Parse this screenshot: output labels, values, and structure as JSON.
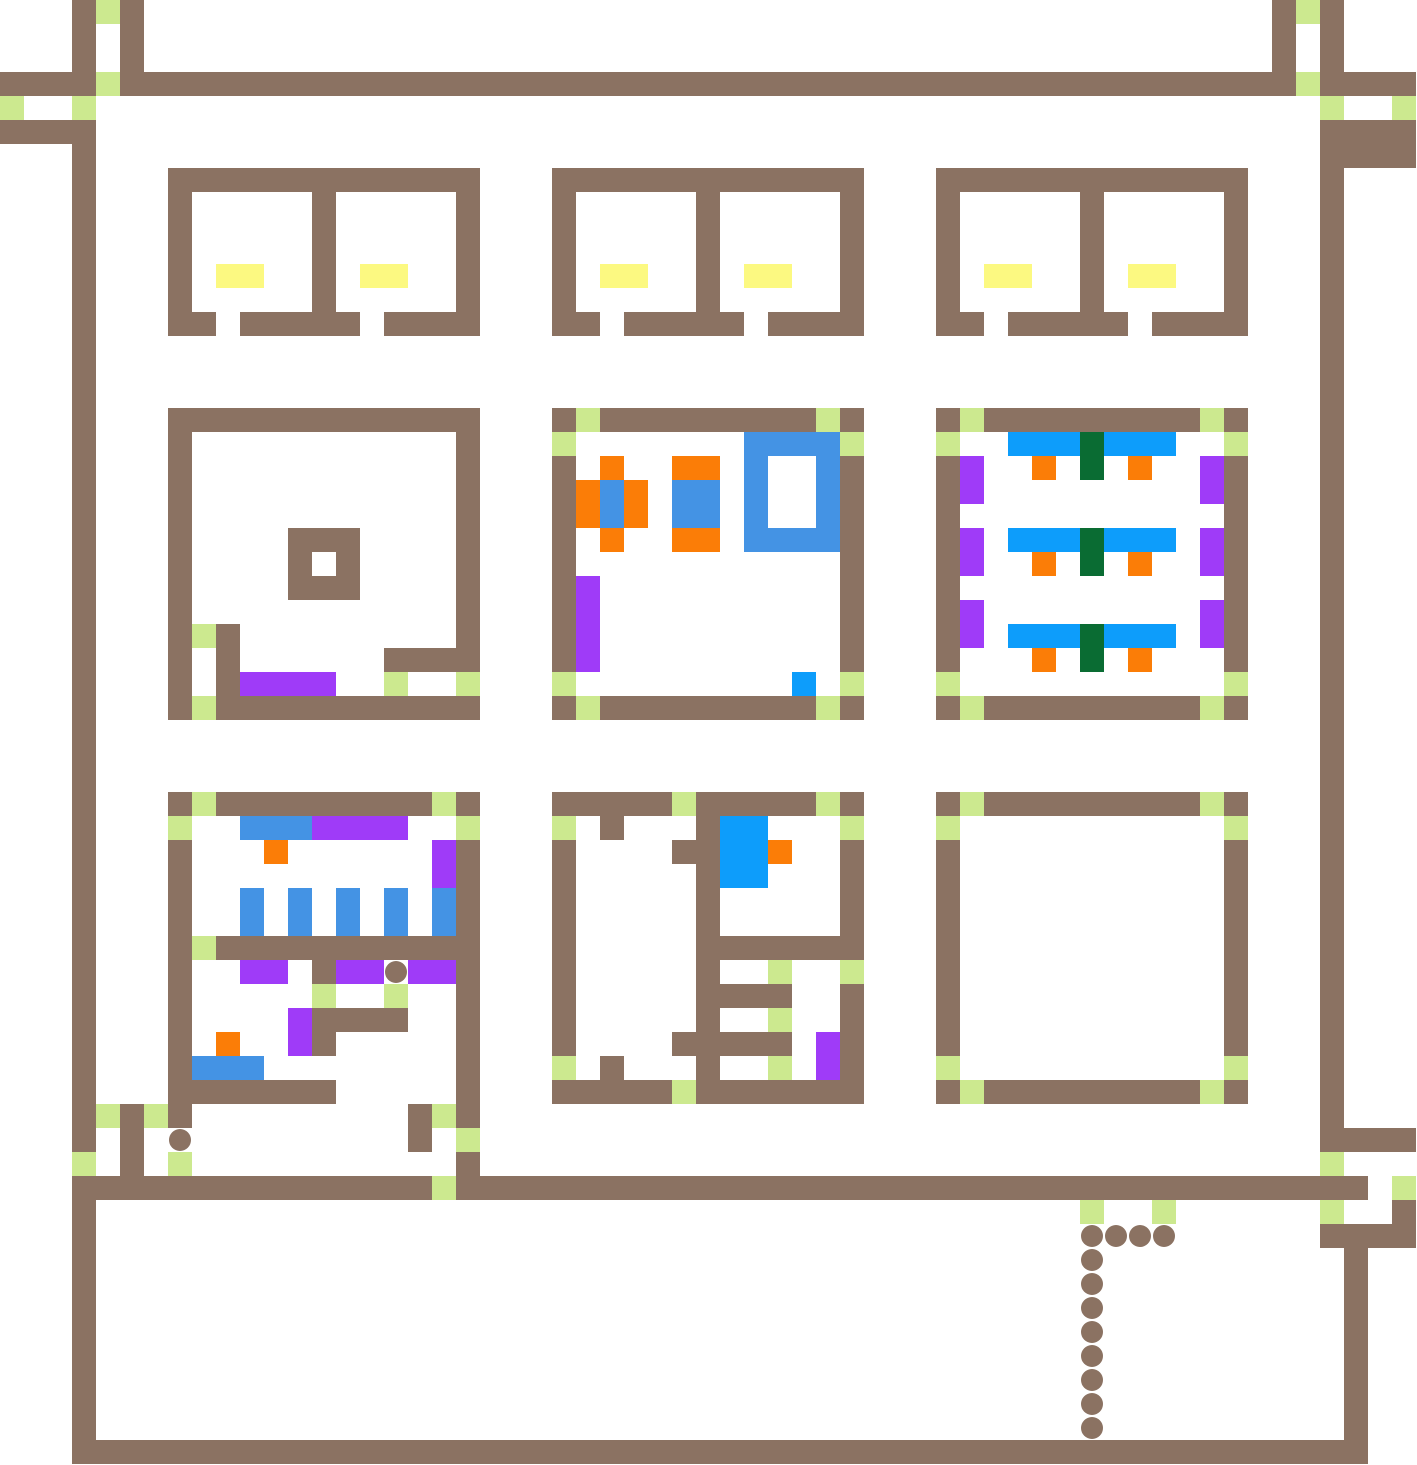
{
  "map": {
    "grid_cols": 59,
    "grid_rows": 61,
    "cell_size": 24,
    "background": "#ffffff",
    "palette": {
      ".": "#ffffff",
      "W": "#8b7262",
      "D": "#cce98f",
      "Y": "#fcf981",
      "B": "#4493e4",
      "C": "#0d9dfb",
      "O": "#fb7d07",
      "P": "#9f3bf8",
      "G": "#0a6c33",
      "o": "#8b7262"
    },
    "legend": {
      ".": "floor",
      "W": "wall-segment",
      "D": "door-tile",
      "Y": "bed-tile",
      "B": "blue-furniture",
      "C": "bright-blue-furniture",
      "O": "orange-chair",
      "P": "purple-bench",
      "G": "green-table",
      "o": "path-dot"
    },
    "rows": [
      "3. W D W 47. W D W 3.",
      "3. W . W 47. W . W 3.",
      "3. W . W 47. W . W 3.",
      "4W D 49W D 4W",
      "D 2. D 51. D 2. D",
      "4W 51. 4W",
      "3. W 51. 4W",
      "3. W 3. 13W 3. 13W 3. 13W 3. W 3.",
      "3. W 3. W 5. W 5. W 3. W 5. W 5. W 3. W 5. W 5. W 3. W 3.",
      "3. W 3. W 5. W 5. W 3. W 5. W 5. W 3. W 5. W 5. W 3. W 3.",
      "3. W 3. W 5. W 5. W 3. W 5. W 5. W 3. W 5. W 5. W 3. W 3.",
      "3. W 3. W . 2Y 2. W . 2Y 2. W 3. W . 2Y 2. W . 2Y 2. W 3. W . 2Y 2. W . 2Y 2. W 3. W 3.",
      "3. W 3. W 5. W 5. W 3. W 5. W 5. W 3. W 5. W 5. W 3. W 3.",
      "3. W 3. 2W . 5W . 4W 3. 2W . 5W . 4W 3. 2W . 5W . 4W 3. W 3.",
      "3. W 51. W 3.",
      "3. W 51. W 3.",
      "3. W 51. W 3.",
      "3. W 3. 13W 3. W D 9W D W 3. W D 9W D W 3. W 3.",
      "3. W 3. W 11. W 3. D 7. 4B D 3. D 2. 3C G 3C 2. D 3. W 3.",
      "3. W 3. W 11. W 3. W . O 2. 2O . B 2. B W 3. W P 2. O . G . O 2. P W 3. W 3.",
      "3. W 3. W 11. W 3. W O B O . 2B . B 2. B W 3. W P 9. P W 3. W 3.",
      "3. W 3. W 11. W 3. W O B O . 2B . B 2. B W 3. W 11. W 3. W 3.",
      "3. W 3. W 4. 3W 4. W 3. W . O 2. 2O . 4B W 3. W P . 3C G 3C . P W 3. W 3.",
      "3. W 3. W 4. W . W 4. W 3. W 11. W 3. W P 2. O . G . O 2. P W 3. W 3.",
      "3. W 3. W 4. 3W 4. W 3. W P 10. W 3. W 11. W 3. W 3.",
      "3. W 3. W 11. W 3. W P 10. W 3. W P 9. P W 3. W 3.",
      "3. W 3. W D W 9. W 3. W P 10. W 3. W P . 3C G 3C . P W 3. W 3.",
      "3. W 3. W . W 6. 4W 3. W P 10. W 3. W 3. O . G . O 3. W 3. W 3.",
      "3. W 3. W . W 4P 2. D 2. D 3. D 9. C . D 3. D 11. D 3. W 3.",
      "3. W 3. W D 11W 3. W D 9W D W 3. W D 9W D W 3. W 3.",
      "3. W 51. W 3.",
      "3. W 51. W 3.",
      "3. W 51. W 3.",
      "3. W 3. W D 9W D W 3. 5W D 5W D W 3. W D 9W D W 3. W 3.",
      "3. W 3. D 2. 3B 4P 2. D 3. D . W 3. W 2C 3. D 3. D 11. D 3. W 3.",
      "3. W 3. W 3. O 6. P W 3. W 4. 2W 2C O 2. W 3. W 11. W 3. W 3.",
      "3. W 3. W 10. P W 3. W 5. W 2C 3. W 3. W 11. W 3. W 3.",
      "3. W 3. W 2. B . B . B . B . B W 3. W 5. W 5. W 3. W 11. W 3. W 3.",
      "3. W 3. W 2. B . B . B . B . B W 3. W 5. W 5. W 3. W 11. W 3. W 3.",
      "3. W 3. W D 11W 3. W 5. 7W 3. W 11. W 3. W 3.",
      "3. W 3. W 2. 2P . W 2P o 2P W 3. W 5. W 2. D 2. D 3. W 11. W 3. W 3.",
      "3. W 3. W 5. D 2. D 2. W 3. W 5. 4W 2. W 3. W 11. W 3. W 3.",
      "3. W 3. W 4. P 4W 2. W 3. W 5. W 2. D 2. W 3. W 11. W 3. W 3.",
      "3. W 3. W . O 2. P W 5. W 3. W 4. 5W . P W 3. W 11. W 3. W 3.",
      "3. W 3. W 3B 8. W 3. D . W 3. W 2. D . P W 3. D 11. D 3. W 3.",
      "3. W 3. 7W 5. W 3. 5W D 7W 3. W D 9W D W 3. W 3.",
      "3. W D W D W 9. W D W 35. W 3.",
      "3. W . W . o 9. W . D 35. 4W",
      "3. D . W . D 11. W 35. D 3.",
      "3. 15W D 38W . D",
      "3. W 41. D 2. D 6. D 2. W",
      "3. W 41. 4o 6. 4W",
      "3. W 41. o 10. W 2.",
      "3. W 41. o 10. W 2.",
      "3. W 41. o 10. W 2.",
      "3. W 41. o 10. W 2.",
      "3. W 41. o 10. W 2.",
      "3. W 41. o 10. W 2.",
      "3. W 41. o 10. W 2.",
      "3. W 41. o 10. W 2.",
      "3. 54W 2."
    ]
  }
}
